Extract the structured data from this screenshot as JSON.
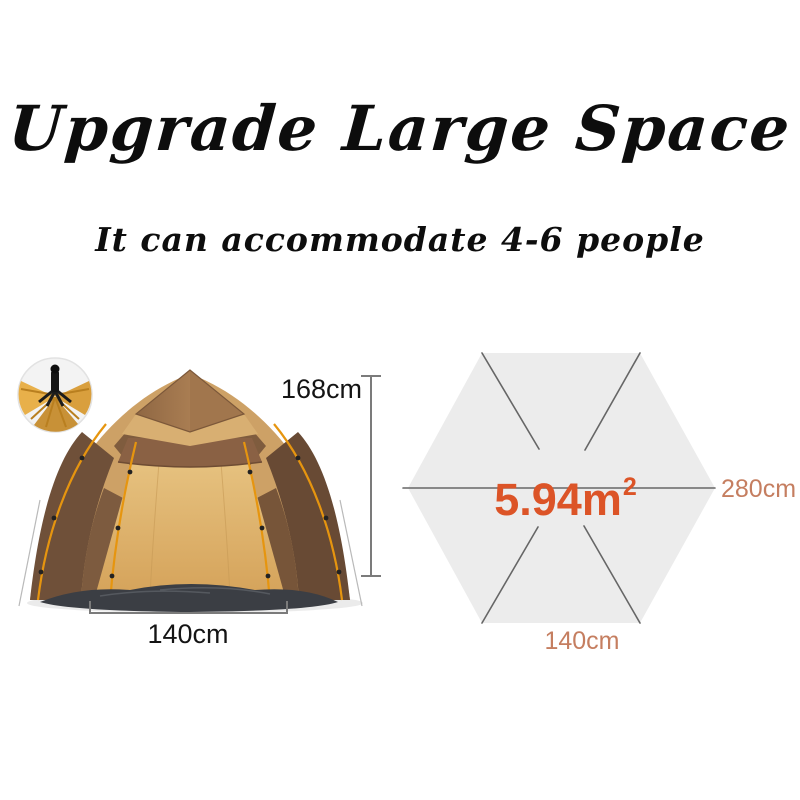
{
  "header": {
    "title": "Upgrade Large Space",
    "subtitle": "It can accommodate 4-6 people"
  },
  "tent_figure": {
    "height_label": "168cm",
    "width_label": "140cm"
  },
  "floor_diagram": {
    "area_value": "5.94m",
    "area_superscript": "2",
    "width_label": "280cm",
    "edge_label": "140cm"
  },
  "colors": {
    "title_text": "#0d0d0d",
    "area_text": "#dc5427",
    "diagram_label_text": "#c57e60",
    "dimension_text": "#141414",
    "dimension_line": "#7b7b7b",
    "hexagon_fill": "#ececec",
    "hexagon_line": "#666666"
  }
}
